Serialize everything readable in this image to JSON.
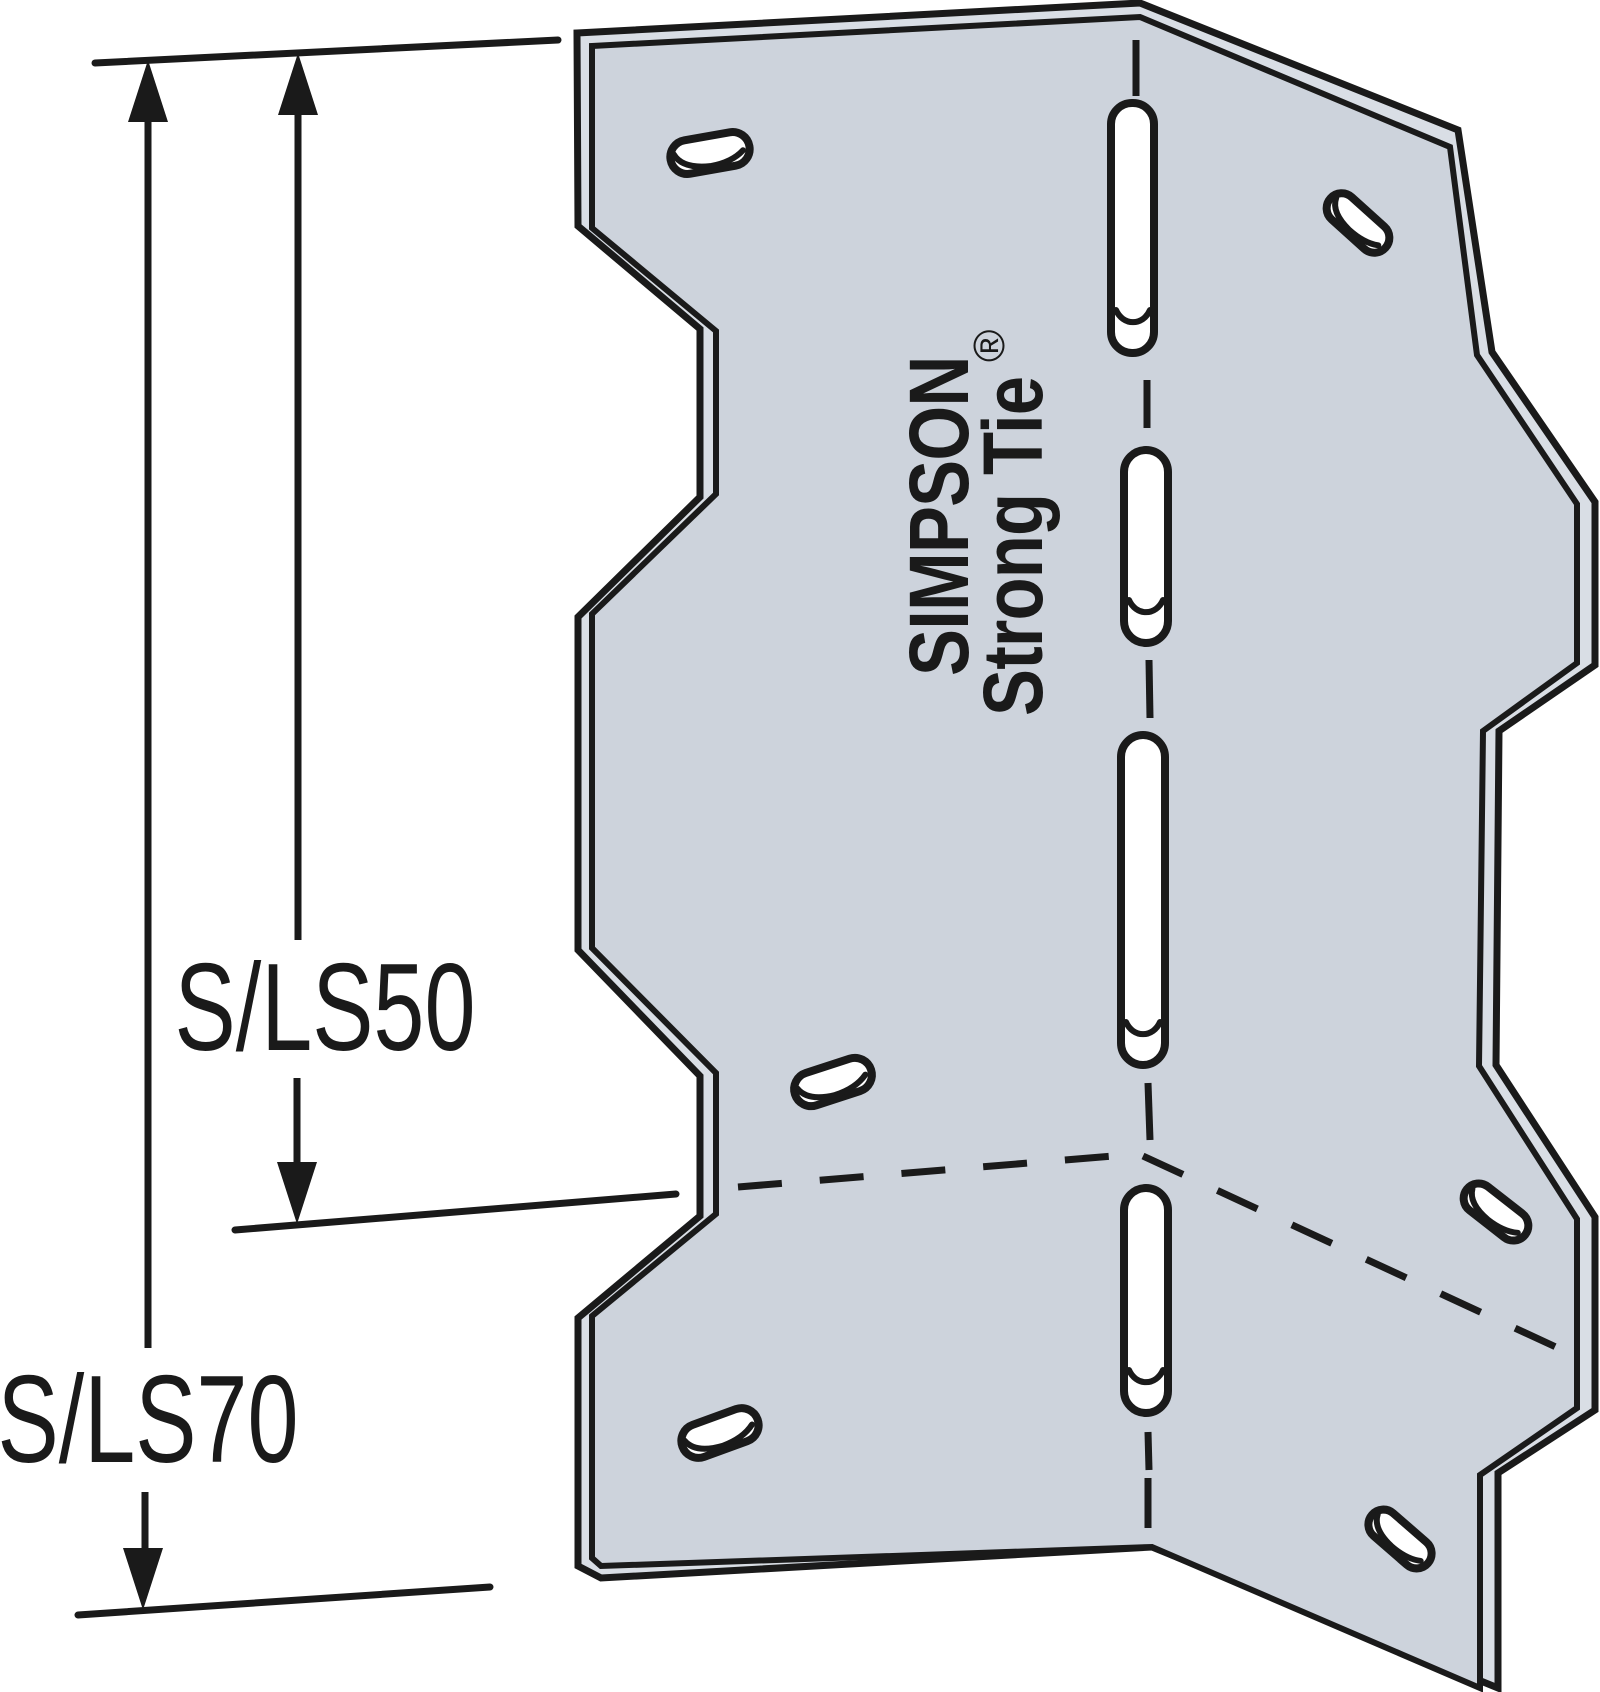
{
  "diagram": {
    "type": "product-line-art",
    "subject": "skewable-angle-bracket",
    "plate": {
      "logo_line1": "SIMPSON",
      "logo_line2": "Strong Tie",
      "registered_mark": "®"
    },
    "dimensions": [
      {
        "label": "S/LS50"
      },
      {
        "label": "S/LS70"
      }
    ],
    "colors": {
      "plate": "#cdd3dc",
      "plate_edge": "#d9dee5",
      "line": "#1a1a1a",
      "hole": "#ffffff",
      "background": "#ffffff"
    }
  }
}
